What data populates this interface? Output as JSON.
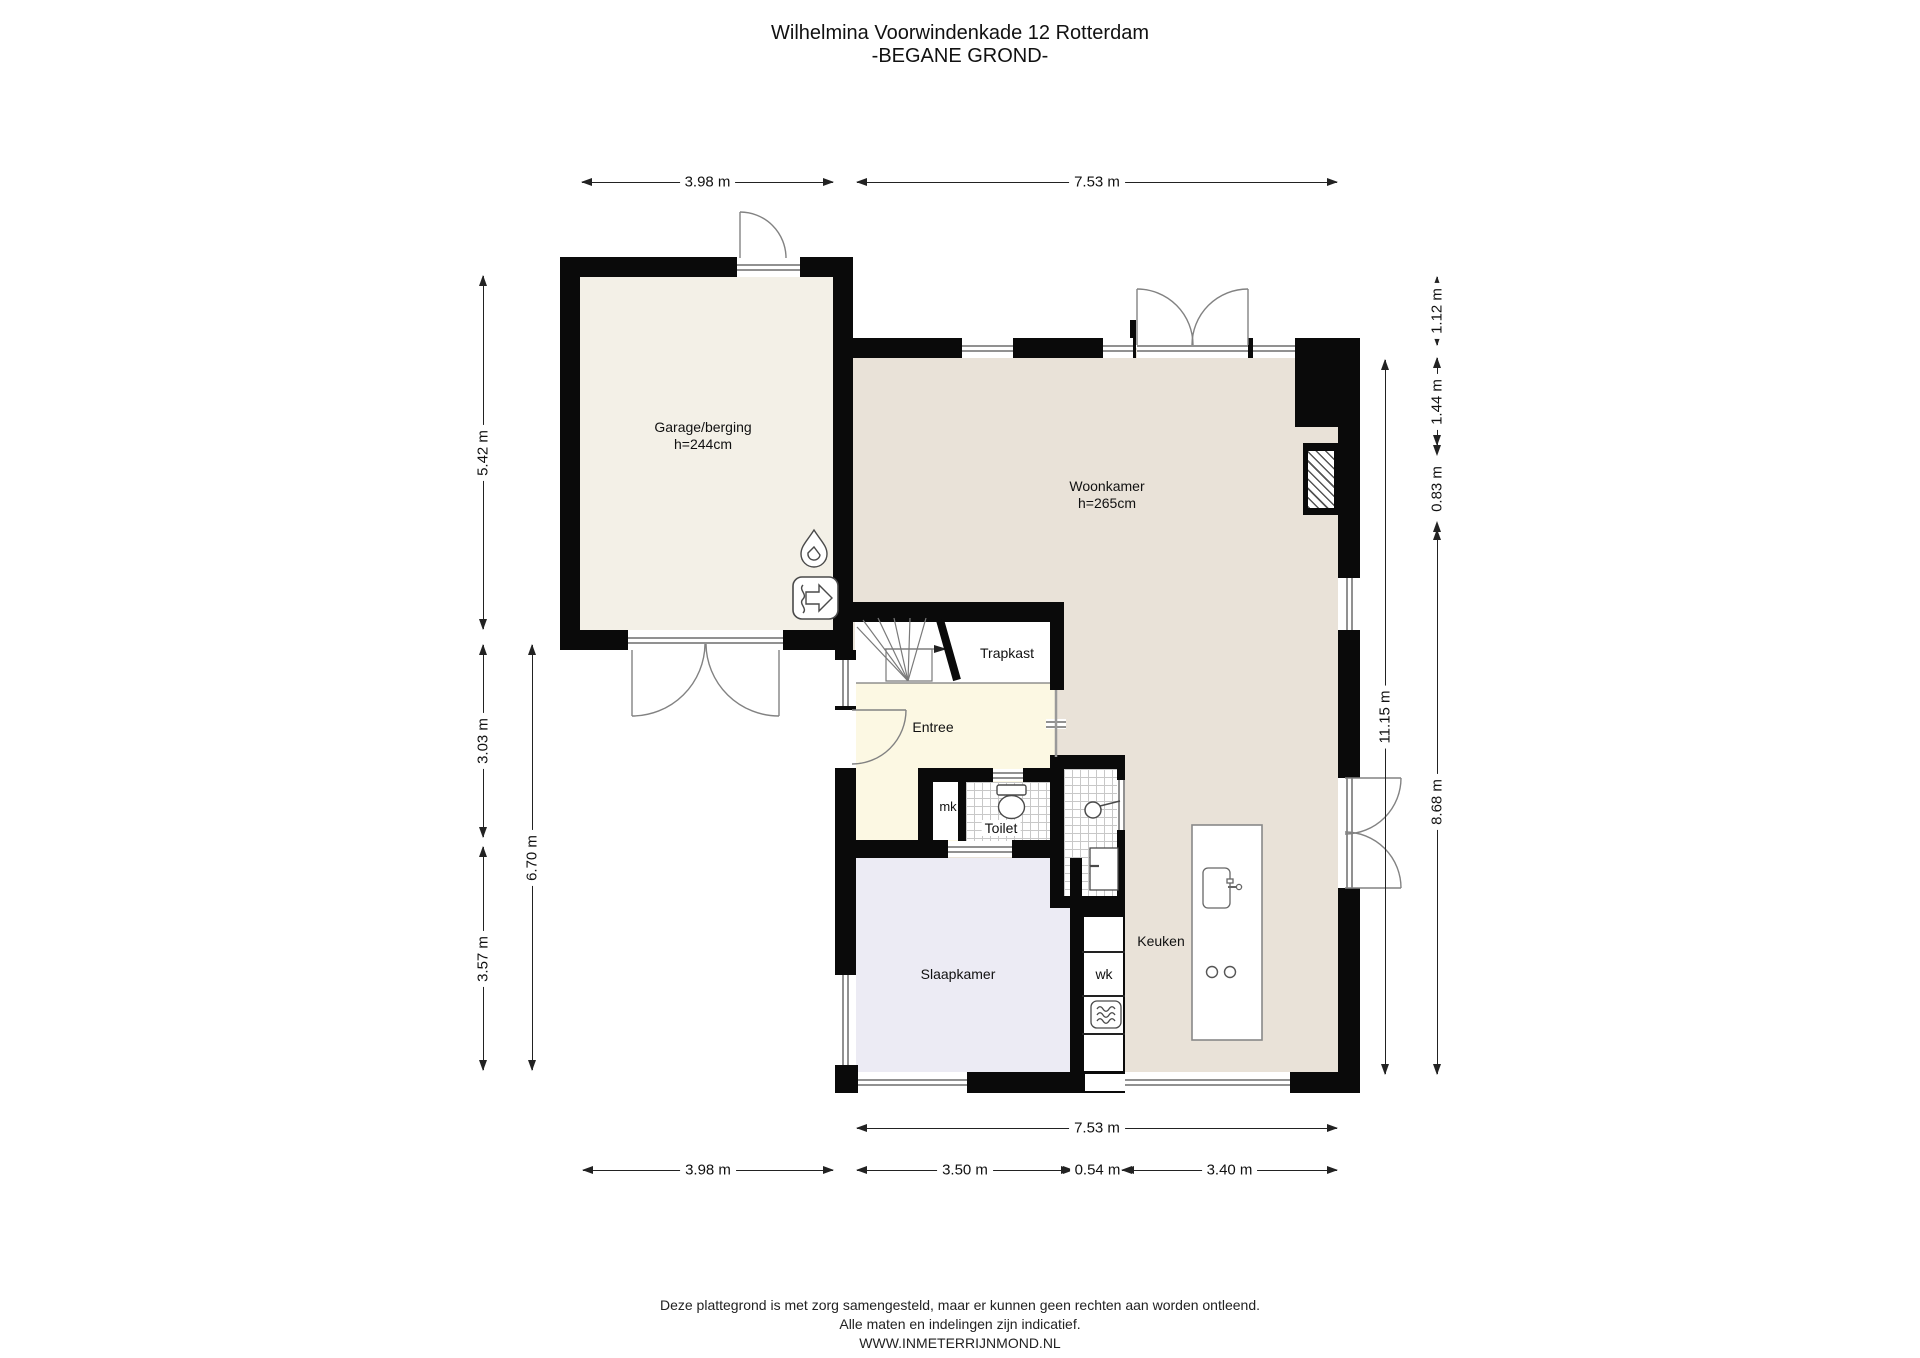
{
  "title": {
    "line1": "Wilhelmina Voorwindenkade 12 Rotterdam",
    "line2": "-BEGANE GROND-"
  },
  "rooms": {
    "garage": {
      "name": "Garage/berging",
      "height": "h=244cm"
    },
    "woonkamer": {
      "name": "Woonkamer",
      "height": "h=265cm"
    },
    "trapkast": {
      "name": "Trapkast"
    },
    "entree": {
      "name": "Entree"
    },
    "mk": {
      "name": "mk"
    },
    "toilet": {
      "name": "Toilet"
    },
    "slaapkamer": {
      "name": "Slaapkamer"
    },
    "wk": {
      "name": "wk"
    },
    "keuken": {
      "name": "Keuken"
    }
  },
  "dims": {
    "top_garage": "3.98 m",
    "top_main": "7.53 m",
    "left_garage": "5.42 m",
    "left_mid": "3.03 m",
    "left_bottom": "3.57 m",
    "left_total": "6.70 m",
    "right_top": "1.12 m",
    "right_upper": "1.44 m",
    "right_shaft": "0.83 m",
    "right_lower": "8.68 m",
    "right_total": "11.15 m",
    "bottom_main": "7.53 m",
    "bottom_garage": "3.98 m",
    "bottom_left": "3.50 m",
    "bottom_mid": "0.54 m",
    "bottom_right": "3.40 m"
  },
  "footer": {
    "line1": "Deze plattegrond is met zorg samengesteld, maar er kunnen geen rechten aan worden ontleend.",
    "line2": "Alle maten en indelingen zijn indicatief.",
    "line3": "WWW.INMETERRIJNMOND.NL"
  },
  "icons": [
    "flame-icon",
    "ventilation-unit-icon",
    "shower-head-icon",
    "washbasin-icon",
    "toilet-icon",
    "kitchen-sink-icon",
    "hob-burners-icon",
    "oven-icon",
    "stair-direction-arrow-icon"
  ],
  "colors": {
    "wall": "#0a0a0a",
    "garage_floor": "#f3f0e7",
    "living_floor": "#e9e2d8",
    "entree_floor": "#fcf8e3",
    "bedroom_floor": "#ecebf4",
    "dimension_line": "#222222",
    "window_line": "#919191"
  }
}
